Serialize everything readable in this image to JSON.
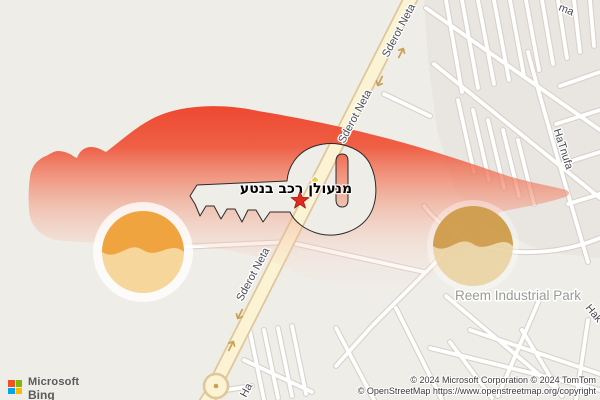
{
  "map": {
    "road_labels": {
      "top": "Sderot Neta",
      "mid": "Sderot Neta",
      "bottom": "Sderot Neta"
    },
    "street_labels": {
      "hatnufa": "HaTnufa",
      "partial_top": "ma",
      "partial_right": "Hak",
      "partial_bottom": "Ha"
    },
    "area_labels": {
      "industrial_park": "Reem Industrial Park"
    },
    "poi": {
      "title": "מנעולן רכב בנטע",
      "marker": "red-star"
    },
    "colors": {
      "background": "#EFEDE8",
      "urban_block": "#E9E5E1",
      "road_fill": "#FBF3D4",
      "road_casing": "#DEC79B",
      "street_fill": "#FFFFFF",
      "street_casing": "#D7D2CB",
      "road_arrow": "#C9A054",
      "car_red": "#EE4530",
      "wheel_orange": "#EFA440",
      "wheel_light": "#F6D69B",
      "star_red": "#E02B1E",
      "poi_diamond": "#ECCB55"
    }
  },
  "branding": {
    "microsoft": "Microsoft",
    "bing": "Bing",
    "logo_colors": {
      "red": "#F25022",
      "green": "#7FBA00",
      "blue": "#00A4EF",
      "yellow": "#FFB900"
    }
  },
  "attribution": {
    "line1": "© 2024 Microsoft Corporation © 2024 TomTom",
    "line2": "© OpenStreetMap https://www.openstreetmap.org/copyright"
  }
}
